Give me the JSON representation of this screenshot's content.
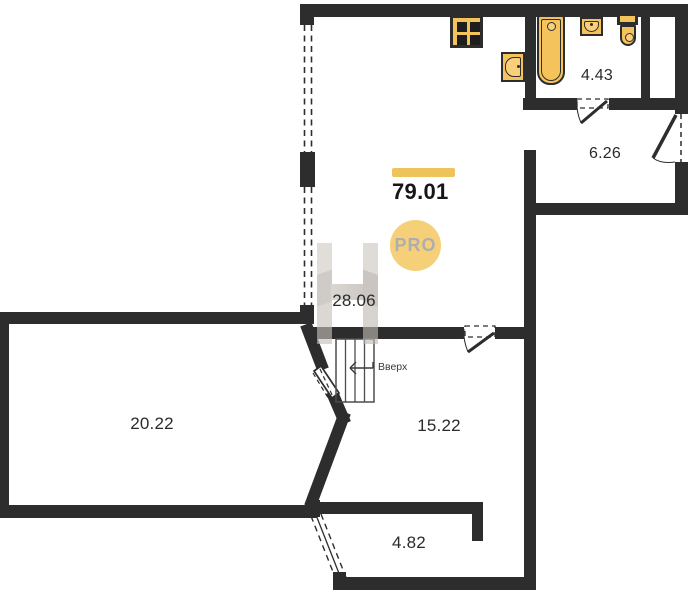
{
  "plan": {
    "total_area": "79.01",
    "badge": "PRO",
    "stairs_label": "Вверх",
    "rooms": {
      "studio": "28.06",
      "living": "20.22",
      "hall": "15.22",
      "loggia": "4.82",
      "entry": "6.26",
      "bathroom": "4.43"
    },
    "colors": {
      "wall": "#2d2d2d",
      "fixture": "#f5c35c",
      "accent_bar": "#edc35b",
      "badge_bg": "#f6d078",
      "badge_text": "#aeaeae"
    }
  }
}
